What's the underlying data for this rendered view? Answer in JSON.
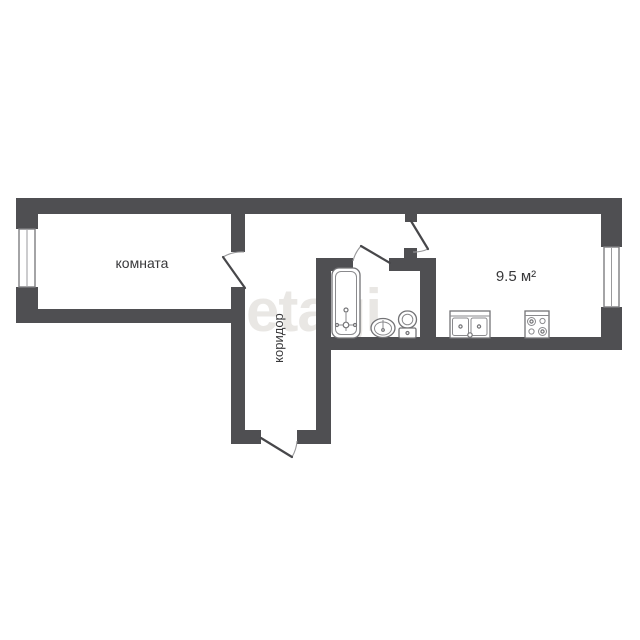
{
  "floorplan": {
    "watermark": "etagi",
    "labels": {
      "room": "комната",
      "corridor": "коридор",
      "kitchen_area": "9.5 м²"
    },
    "colors": {
      "background": "#ffffff",
      "wall": "#4f4f52",
      "fixture_stroke": "#737376",
      "label_text": "#38383a",
      "watermark": "#e9e7e4"
    },
    "fixtures": [
      "bathtub-icon",
      "washbasin-icon",
      "toilet-icon",
      "kitchen-sink-icon",
      "stove-icon"
    ],
    "window_count": "2",
    "door_count": "4"
  }
}
